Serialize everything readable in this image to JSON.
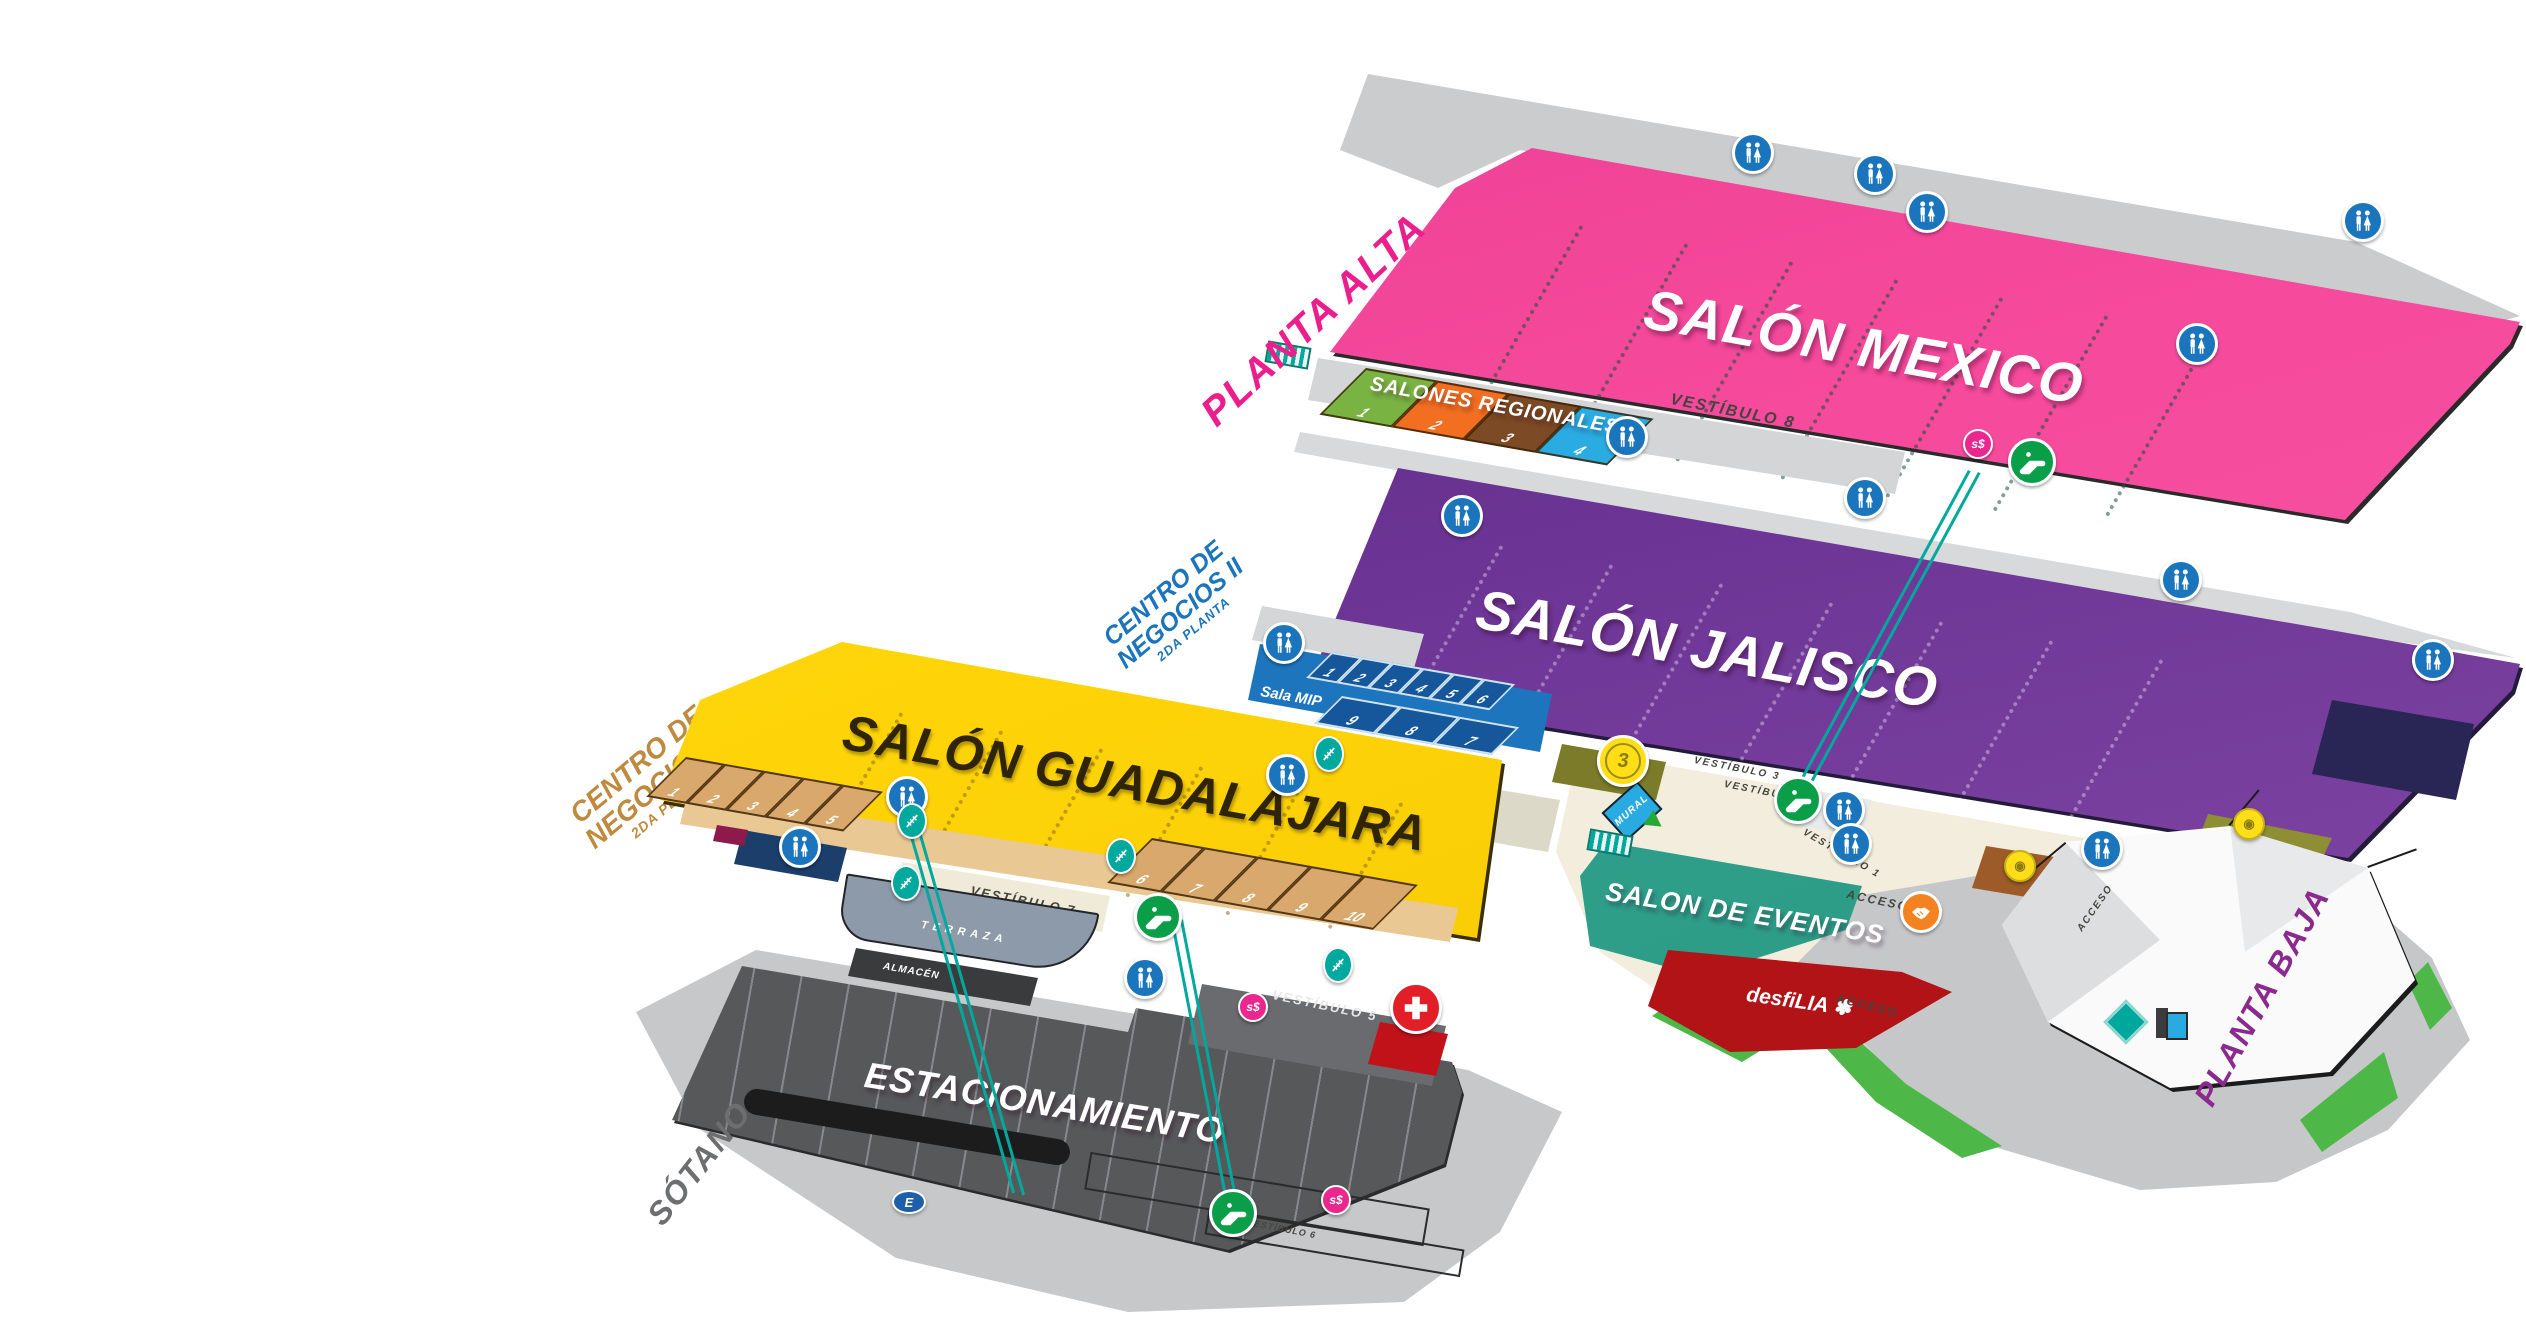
{
  "levels": {
    "planta_alta": {
      "label": "PLANTA ALTA",
      "color": "#EC1E8C"
    },
    "planta_baja": {
      "label": "PLANTA BAJA",
      "color": "#8A2A8F"
    },
    "sotano": {
      "label": "SÓTANO",
      "color": "#6D6E70"
    }
  },
  "salons": {
    "mexico": {
      "name": "SALÓN MEXICO",
      "color": "#F0409B"
    },
    "jalisco": {
      "name": "SALÓN JALISCO",
      "color": "#6B3494"
    },
    "guadalajara": {
      "name": "SALÓN GUADALAJARA",
      "color": "#FFD60A"
    },
    "eventos": {
      "name": "SALON DE EVENTOS",
      "color": "#2EA28D"
    },
    "desfilia": {
      "name": "desfiLIA",
      "flower": "✽",
      "color": "#B11317"
    },
    "estacionamiento": {
      "name": "ESTACIONAMIENTO",
      "color": "#57585A"
    }
  },
  "centro_negocios": {
    "l1": "CENTRO DE",
    "l2": "NEGOCIOS II",
    "l3": "2DA PLANTA",
    "color_jalisco": "#1B75BC",
    "color_guadalajara": "#C08A3E"
  },
  "salones_regionales": {
    "label": "SALONES REGIONALES",
    "rooms": [
      "1",
      "2",
      "3",
      "4"
    ],
    "room_colors": [
      "#79B342",
      "#F26F21",
      "#7C4A24",
      "#2AACE3"
    ]
  },
  "sala_mip": {
    "label": "Sala MIP",
    "row1": [
      "1",
      "2",
      "3",
      "4",
      "5",
      "6"
    ],
    "row2": [
      "9",
      "8",
      "7"
    ]
  },
  "guadalajara_rooms": {
    "row1": [
      "1",
      "2",
      "3",
      "4",
      "5"
    ],
    "row2": [
      "6",
      "7",
      "8",
      "9",
      "10"
    ]
  },
  "vestibulos": {
    "v8": "VESTÍBULO 8",
    "v4": "VESTÍBULO 4",
    "v3": "VESTÍBULO 3",
    "v3_badge": "3",
    "v7": "VESTÍBULO 7",
    "v5": "VESTÍBULO 5",
    "v6": "VESTÍBULO 6",
    "v2": "VESTÍBULO 2",
    "v1": "VESTÍBULO 1"
  },
  "areas": {
    "terraza": "TERRAZA",
    "almacen": "ALMACÉN",
    "acceso": "ACCESO",
    "mural": "MURAL"
  },
  "markers": {
    "atm_label": "s$",
    "parking_entrance": "E"
  },
  "icons": {
    "restroom": "blue circle, man+woman figures",
    "escalator": "green circle, escalator",
    "stairs": "teal oval, stairs",
    "first_aid": "red circle, white cross",
    "meeting_point": "orange circle, handshake",
    "badge": "yellow seal badge"
  }
}
